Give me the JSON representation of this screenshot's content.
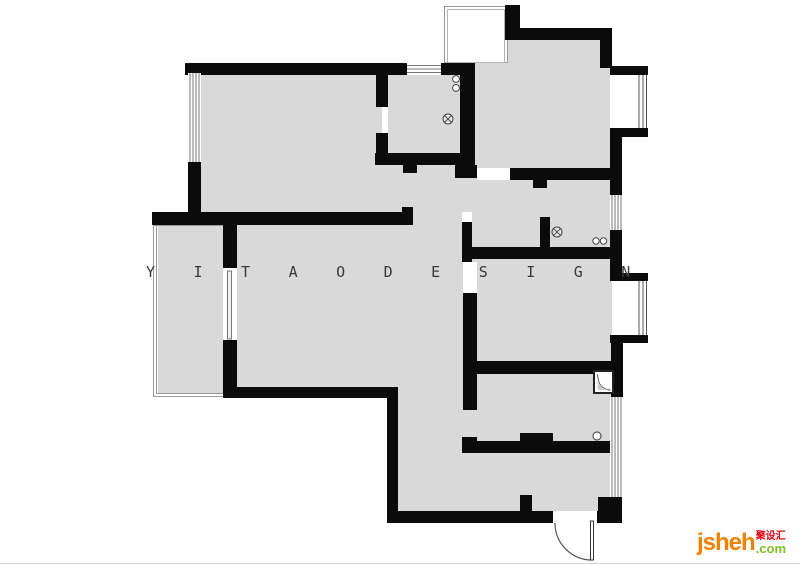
{
  "watermark": {
    "text": "YITAODESIGN",
    "color": "#3a3a3a"
  },
  "logo": {
    "brand": "jsheh",
    "suffix": ".com",
    "chinese": "聚设汇",
    "brand_color": "#f08200",
    "suffix_color": "#7fbe26",
    "chinese_color": "#e60012"
  },
  "plan": {
    "type": "apartment-floor-plan",
    "wall_color": "#0b0b0b",
    "floor_color": "#d9d9d9",
    "fixture_icons": [
      "floor-drain-icon",
      "basin-circles-icon",
      "shower-box-icon",
      "entry-door-swing-icon",
      "balcony-door-leaf",
      "window-glazing-lines"
    ]
  }
}
